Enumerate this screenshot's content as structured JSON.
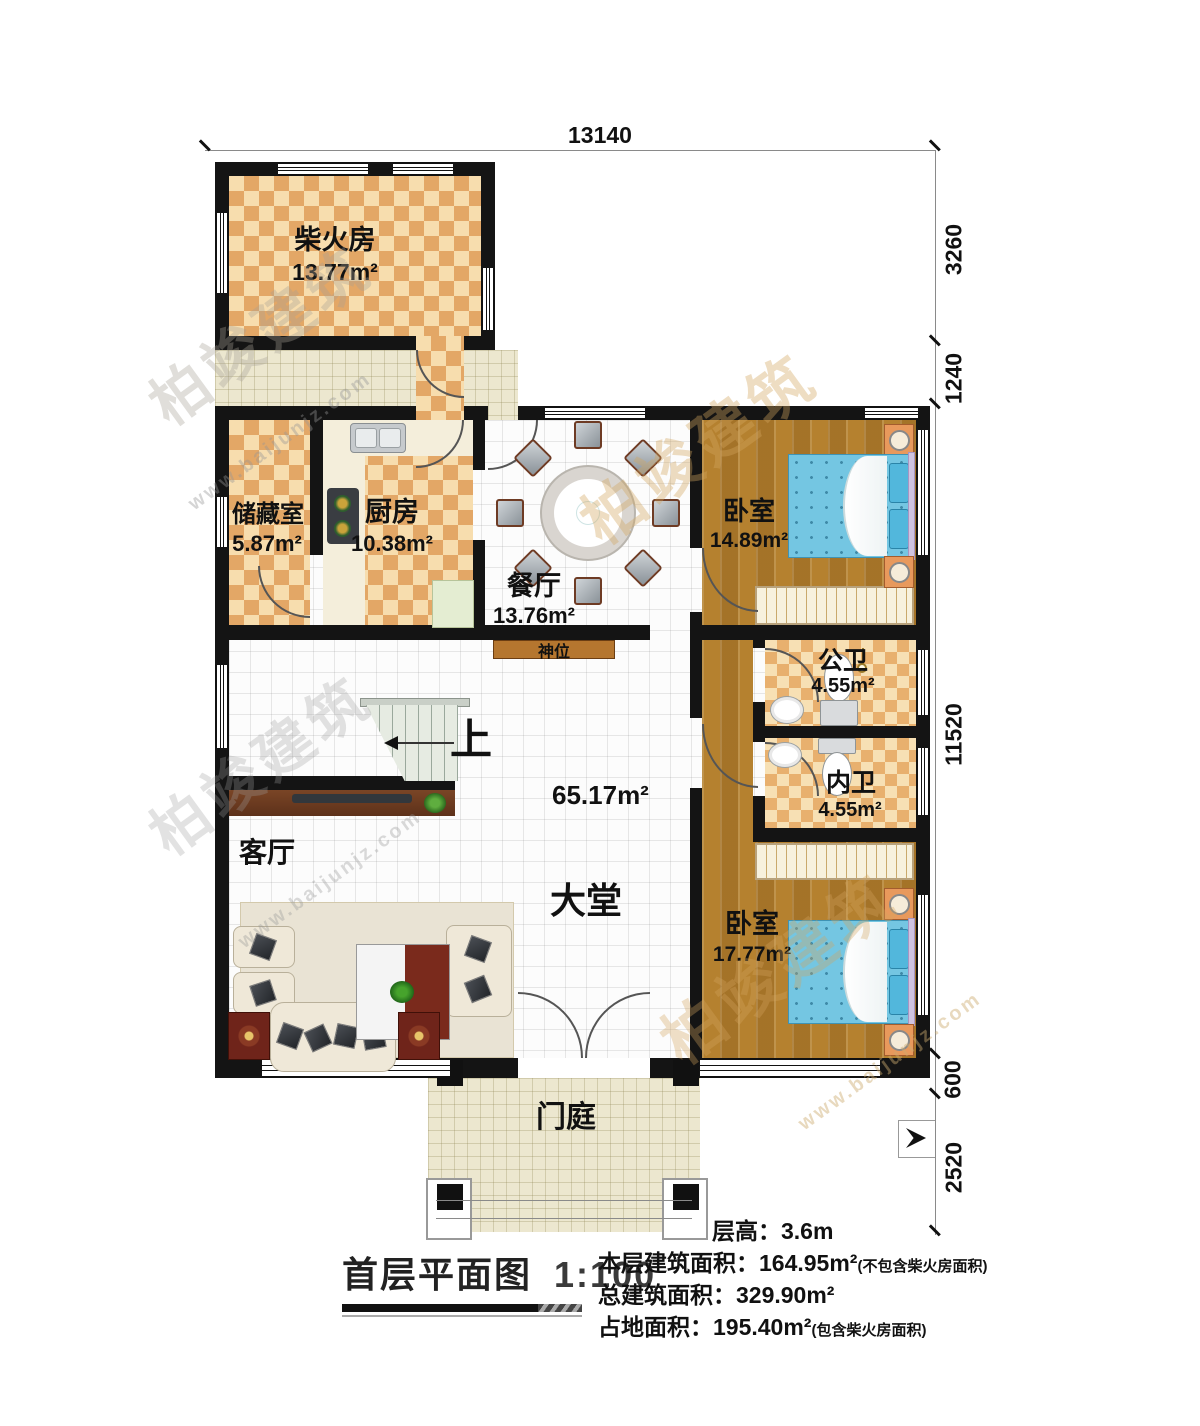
{
  "title": {
    "text": "首层平面图",
    "scale": "1:100"
  },
  "summary": {
    "lines": [
      {
        "label": "层高：",
        "value": "3.6m",
        "note": ""
      },
      {
        "label": "本层建筑面积：",
        "value": "164.95m²",
        "note": "(不包含柴火房面积)"
      },
      {
        "label": "总建筑面积：",
        "value": "329.90m²",
        "note": ""
      },
      {
        "label": "占地面积：",
        "value": "195.40m²",
        "note": "(包含柴火房面积)"
      }
    ]
  },
  "dimensions": {
    "top": "13140",
    "right": [
      "3260",
      "1240",
      "11520",
      "600",
      "2520"
    ]
  },
  "rooms": {
    "firewood": {
      "name": "柴火房",
      "area": "13.77m²"
    },
    "storage": {
      "name": "储藏室",
      "area": "5.87m²"
    },
    "kitchen": {
      "name": "厨房",
      "area": "10.38m²"
    },
    "dining": {
      "name": "餐厅",
      "area": "13.76m²"
    },
    "bedroom1": {
      "name": "卧室",
      "area": "14.89m²"
    },
    "public_bath": {
      "name": "公卫",
      "area": "4.55m²"
    },
    "private_bath": {
      "name": "内卫",
      "area": "4.55m²"
    },
    "bedroom2": {
      "name": "卧室",
      "area": "17.77m²"
    },
    "living": {
      "name": "客厅"
    },
    "hall": {
      "name": "大堂",
      "area": "65.17m²"
    },
    "porch": {
      "name": "门庭"
    }
  },
  "features": {
    "shrine": "神位",
    "stairs_up": "上"
  },
  "watermark": {
    "brand": "柏竣建筑",
    "url": "www.baijunjz.com"
  },
  "colors": {
    "wall": "#141414",
    "checker_dark": "#e3a766",
    "checker_light": "#f7ddae",
    "wood_floor": "#b5812f",
    "bed_blue": "#74c6e2",
    "shrine_band": "#b5762f",
    "outdoor_tile": "#ece7cf",
    "stair_tread": "#e6ebe2"
  }
}
